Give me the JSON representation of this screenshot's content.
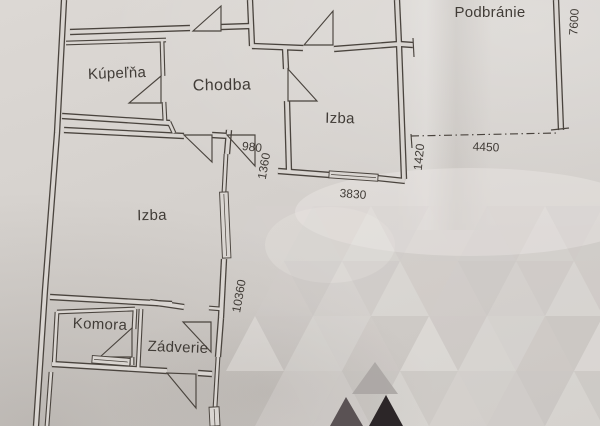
{
  "document": {
    "kind": "scanned floor plan photo"
  },
  "colors": {
    "paper": "#d6d2ce",
    "paper_core": "#d9d5d1",
    "ink": "#4a443e",
    "ink_text": "#413c37",
    "wm_mid": "#aaa5a3",
    "wm_dark": "#5a5254",
    "wm_black": "#2c2628"
  },
  "rooms": [
    {
      "id": "kupelna",
      "label": "Kúpeľňa"
    },
    {
      "id": "chodba",
      "label": "Chodba"
    },
    {
      "id": "izba-upper",
      "label": "Izba"
    },
    {
      "id": "izba-lower",
      "label": "Izba"
    },
    {
      "id": "komora",
      "label": "Komora"
    },
    {
      "id": "zadverie",
      "label": "Zádverie"
    },
    {
      "id": "podbranie",
      "label": "Podbránie"
    }
  ],
  "dimensions": [
    {
      "id": "d980",
      "text": "980"
    },
    {
      "id": "d1360",
      "text": "1360"
    },
    {
      "id": "d3830",
      "text": "3830"
    },
    {
      "id": "d1420",
      "text": "1420"
    },
    {
      "id": "d4450",
      "text": "4450"
    },
    {
      "id": "d7600",
      "text": "7600"
    },
    {
      "id": "d10360",
      "text": "10360"
    }
  ]
}
